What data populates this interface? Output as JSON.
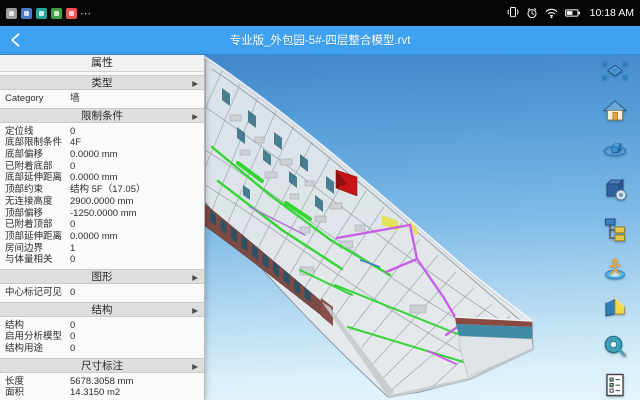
{
  "status_bar": {
    "time": "10:18 AM",
    "overflow_glyph": "⋯",
    "app_icons": [
      {
        "name": "app-icon-gray",
        "color": "#9e9e9e"
      },
      {
        "name": "app-icon-blue",
        "color": "#4a7bc8"
      },
      {
        "name": "app-icon-teal",
        "color": "#26a69a"
      },
      {
        "name": "app-icon-green",
        "color": "#43a047"
      },
      {
        "name": "app-icon-red",
        "color": "#ef5350"
      }
    ],
    "system_icons": [
      "vibrate-icon",
      "alarm-icon",
      "wifi-icon",
      "battery-icon"
    ]
  },
  "title_bar": {
    "title": "专业版_外包园-5#-四层整合模型.rvt",
    "back_icon": "back-chevron-icon"
  },
  "properties_panel": {
    "title": "属性",
    "rows": [
      {
        "type": "header",
        "label": "类型",
        "arrow": "▶"
      },
      {
        "type": "data",
        "label": "Category",
        "value": "墙"
      },
      {
        "type": "header",
        "label": "限制条件",
        "arrow": "▶"
      },
      {
        "type": "data",
        "label": "定位线",
        "value": "0"
      },
      {
        "type": "data",
        "label": "底部限制条件",
        "value": "4F"
      },
      {
        "type": "data",
        "label": "底部偏移",
        "value": "0.0000 mm"
      },
      {
        "type": "data",
        "label": "已附着底部",
        "value": "0"
      },
      {
        "type": "data",
        "label": "底部延伸距离",
        "value": "0.0000 mm"
      },
      {
        "type": "data",
        "label": "顶部约束",
        "value": "结构 5F（17.05）"
      },
      {
        "type": "data",
        "label": "无连接高度",
        "value": "2900.0000 mm"
      },
      {
        "type": "data",
        "label": "顶部偏移",
        "value": "-1250.0000 mm"
      },
      {
        "type": "data",
        "label": "已附着顶部",
        "value": "0"
      },
      {
        "type": "data",
        "label": "顶部延伸距离",
        "value": "0.0000 mm"
      },
      {
        "type": "data",
        "label": "房间边界",
        "value": "1"
      },
      {
        "type": "data",
        "label": "与体量相关",
        "value": "0"
      },
      {
        "type": "header",
        "label": "图形",
        "arrow": "▶"
      },
      {
        "type": "data",
        "label": "中心标记可见",
        "value": "0"
      },
      {
        "type": "header",
        "label": "结构",
        "arrow": "▶"
      },
      {
        "type": "data",
        "label": "结构",
        "value": "0"
      },
      {
        "type": "data",
        "label": "启用分析模型",
        "value": "0"
      },
      {
        "type": "data",
        "label": "结构用途",
        "value": "0"
      },
      {
        "type": "header",
        "label": "尺寸标注",
        "arrow": "▶"
      },
      {
        "type": "data",
        "label": "长度",
        "value": "5678.3058 mm"
      },
      {
        "type": "data",
        "label": "面积",
        "value": "14.3150 m2"
      }
    ]
  },
  "toolbar": {
    "buttons": [
      {
        "id": "fit-view",
        "icon": "fit-view-icon"
      },
      {
        "id": "home-view",
        "icon": "home-icon"
      },
      {
        "id": "orbit",
        "icon": "orbit-icon"
      },
      {
        "id": "model-browser",
        "icon": "model-box-icon"
      },
      {
        "id": "structure-tree",
        "icon": "tree-icon"
      },
      {
        "id": "walkthrough",
        "icon": "walkthrough-icon"
      },
      {
        "id": "section",
        "icon": "section-icon"
      },
      {
        "id": "measure",
        "icon": "measure-icon"
      },
      {
        "id": "checklist",
        "icon": "checklist-icon"
      }
    ]
  },
  "viewport": {
    "colors": {
      "title_bar": "#3ea2f0",
      "sky_top": "#3f85c9",
      "sky_bottom": "#e4f5fc",
      "pipe_green": "#35d435",
      "pipe_magenta": "#c95fe6",
      "duct_yellow": "#e2e258",
      "alert_red": "#c41616",
      "facade_maroon": "#7d4a45",
      "facade_window_teal": "#2c5264",
      "end_band_teal": "#3f8ca6"
    }
  }
}
